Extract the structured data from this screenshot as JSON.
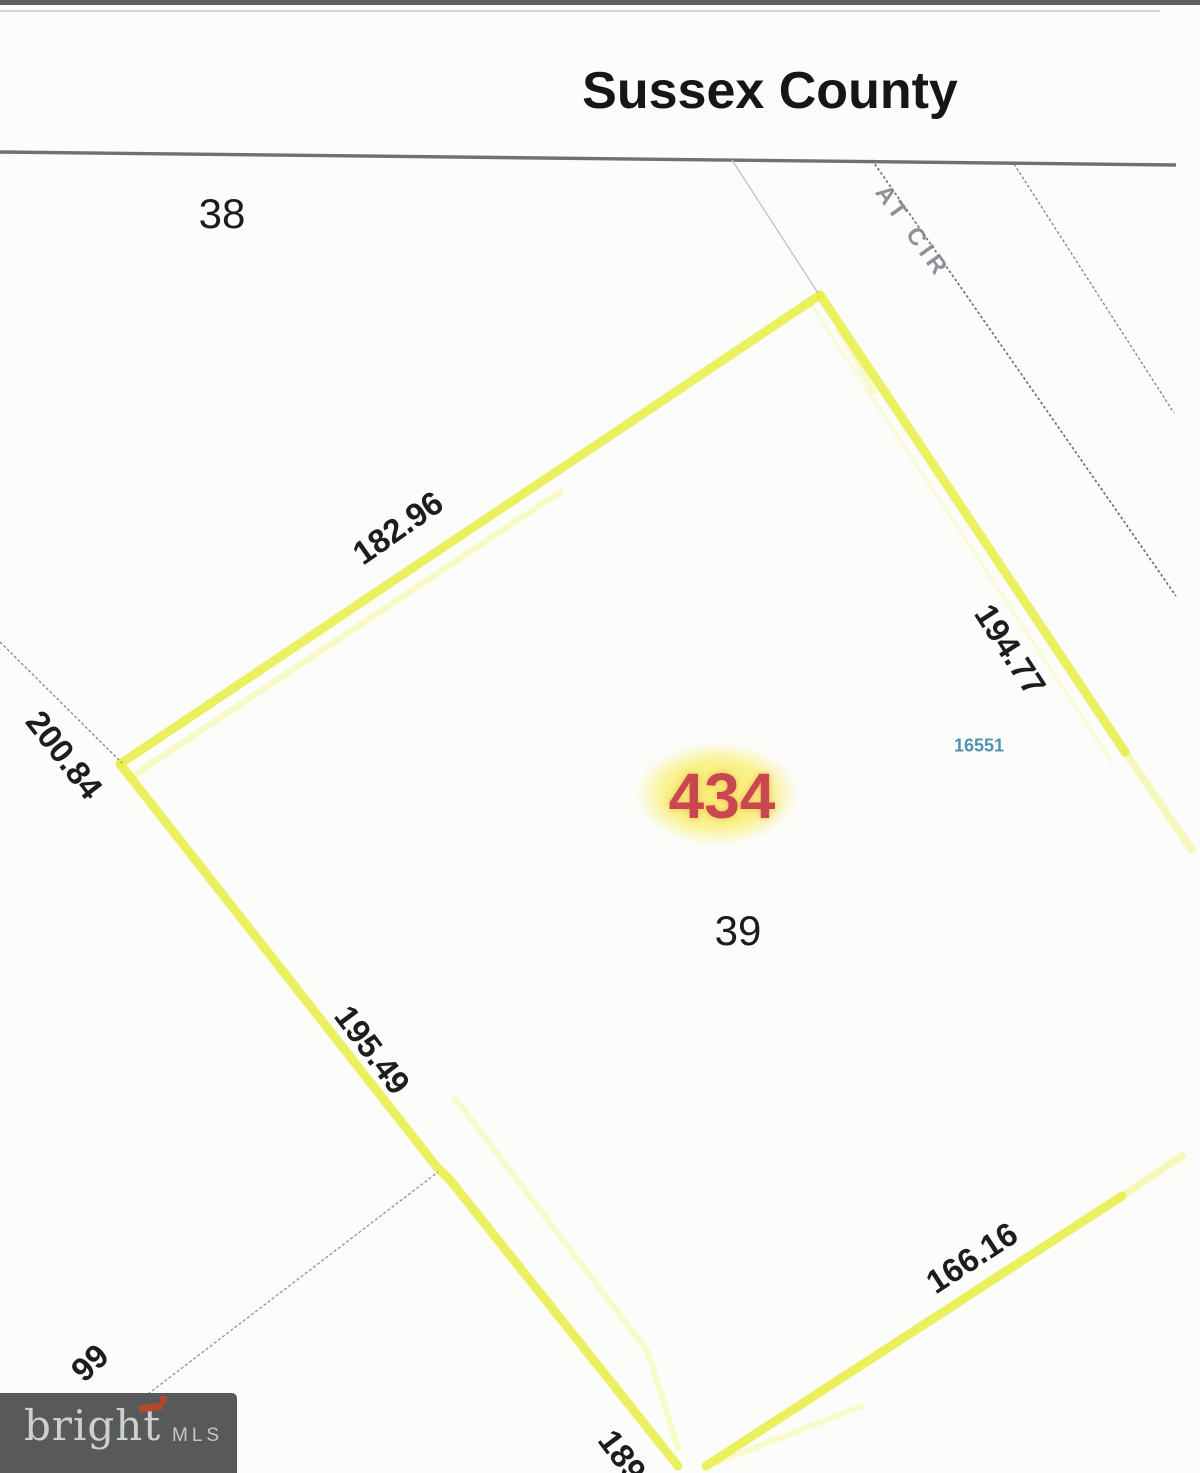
{
  "header": {
    "title": "Sussex County"
  },
  "map": {
    "lots": {
      "adjacent_lot": "38",
      "subject_lot": "39"
    },
    "parcel_id": "434",
    "house_number": "16551",
    "road_label": "AT CIR",
    "dimensions": {
      "northwest_edge": "182.96",
      "northeast_edge": "194.77",
      "west_edge": "200.84",
      "southwest_edge": "195.49",
      "southeast_edge": "166.16",
      "south_edge_partial": "189",
      "west_neighbor_partial": "99"
    }
  },
  "logo": {
    "name": "bright",
    "suffix": "MLS"
  },
  "colors": {
    "hl": "#e8ee45",
    "hllight": "#f3f7a3",
    "red": "#c94750",
    "glow": "#f8ef75",
    "blue": "#4f92b5",
    "purple": "#9f7f95",
    "roadgray": "#6e6d76",
    "logobg": "#58595b",
    "logotext": "#cdd0d1",
    "logoaccent": "#b5472f"
  }
}
